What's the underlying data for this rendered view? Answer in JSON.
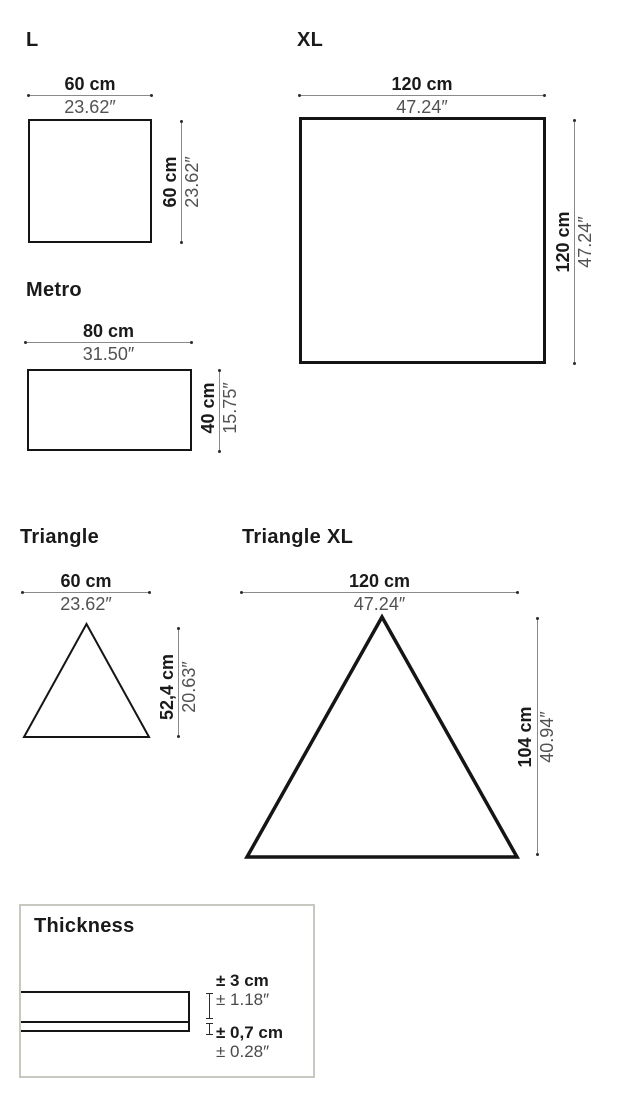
{
  "document": {
    "kind": "product-dimensions-spec-sheet"
  },
  "panels": {
    "l": {
      "title": "L",
      "shape": "square",
      "width": {
        "cm": "60 cm",
        "in": "23.62″"
      },
      "height": {
        "cm": "60 cm",
        "in": "23.62″"
      }
    },
    "xl": {
      "title": "XL",
      "shape": "square",
      "width": {
        "cm": "120 cm",
        "in": "47.24″"
      },
      "height": {
        "cm": "120 cm",
        "in": "47.24″"
      }
    },
    "metro": {
      "title": "Metro",
      "shape": "rectangle",
      "width": {
        "cm": "80 cm",
        "in": "31.50″"
      },
      "height": {
        "cm": "40 cm",
        "in": "15.75″"
      }
    },
    "triangle": {
      "title": "Triangle",
      "shape": "triangle",
      "width": {
        "cm": "60 cm",
        "in": "23.62″"
      },
      "height": {
        "cm": "52,4 cm",
        "in": "20.63″"
      }
    },
    "triangle_xl": {
      "title": "Triangle XL",
      "shape": "triangle",
      "width": {
        "cm": "120 cm",
        "in": "47.24″"
      },
      "height": {
        "cm": "104 cm",
        "in": "40.94″"
      }
    }
  },
  "thickness": {
    "title": "Thickness",
    "total": {
      "cm": "± 3 cm",
      "in": "± 1.18″"
    },
    "felt": {
      "cm": "± 0,7 cm",
      "in": "± 0.28″"
    }
  },
  "colors": {
    "background": "#ffffff",
    "primary_text": "#1a1a1a",
    "secondary_text": "#525252",
    "shape_stroke": "#151515",
    "dimension_line": "#8a8a8a",
    "thickness_box_border": "#c8c8c0"
  }
}
